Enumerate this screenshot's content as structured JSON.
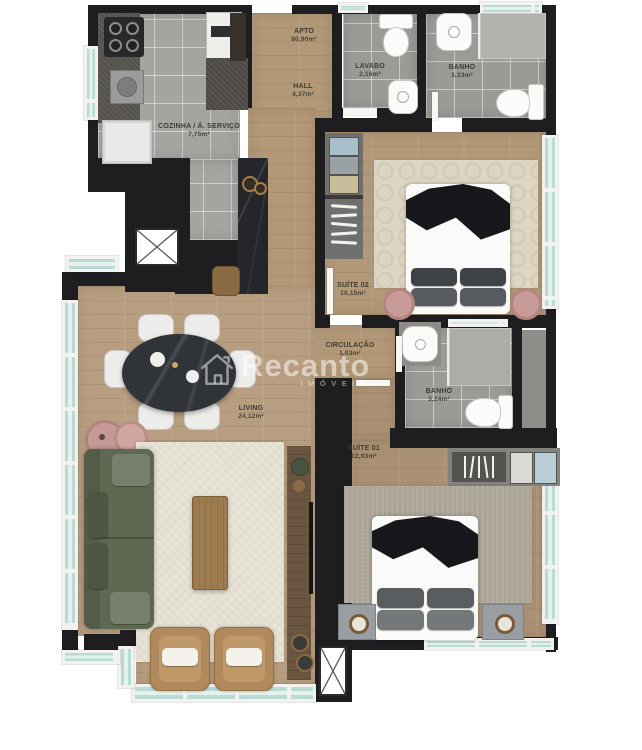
{
  "watermark": {
    "brand": "Recanto",
    "subtitle": "IMÓVEIS"
  },
  "rooms": {
    "apto": {
      "name": "APTO",
      "area": "80,90m²"
    },
    "hall": {
      "name": "HALL",
      "area": "4,37m²"
    },
    "lavabo": {
      "name": "LAVABO",
      "area": "2,16m²"
    },
    "banho_social": {
      "name": "BANHO",
      "area": "3,33m²"
    },
    "cozinha": {
      "name": "COZINHA / Á. SERVIÇO",
      "area": "7,75m²"
    },
    "suite02": {
      "name": "SUÍTE 02",
      "area": "10,15m²"
    },
    "circulacao": {
      "name": "CIRCULAÇÃO",
      "area": "1,03m²"
    },
    "banho_suite": {
      "name": "BANHO",
      "area": "3,24m²"
    },
    "suite01": {
      "name": "SUÍTE 01",
      "area": "12,63m²"
    },
    "living": {
      "name": "LIVING",
      "area": "24,12m²"
    }
  },
  "colors": {
    "wall": "#1e1e20",
    "wood_floor": "#b29877",
    "tile_floor": "#a6a4a1",
    "window_glass": "#b9dbd3",
    "sofa_green": "#5f6952",
    "armchair_tan": "#b08a5c",
    "accent_pink": "#c79b97",
    "watermark_white": "rgba(255,255,255,0.5)"
  }
}
